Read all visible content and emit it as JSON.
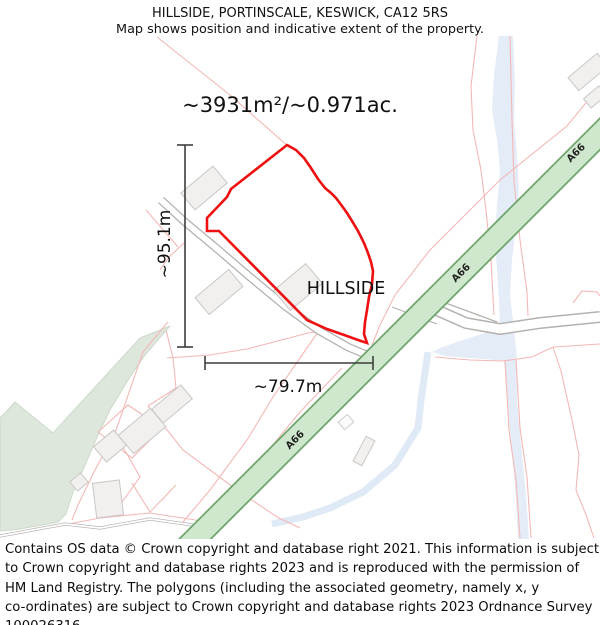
{
  "header": {
    "title": "HILLSIDE, PORTINSCALE, KESWICK, CA12 5RS",
    "subtitle": "Map shows position and indicative extent of the property."
  },
  "map": {
    "area_label": "~3931m²/~0.971ac.",
    "property_label": "HILLSIDE",
    "height_label": "~95.1m",
    "width_label": "~79.7m",
    "road_labels": [
      "A66",
      "A66",
      "A66"
    ],
    "colors": {
      "property_outline": "#ee1010",
      "parcel_line": "#f3b8b6",
      "road_fill": "#cfe8cd",
      "road_casing": "#6ea46e",
      "water": "#e4ecf7",
      "woodland": "#dde7db",
      "building_fill": "#f1f0ef",
      "building_stroke": "#c9c7c4",
      "dimension": "#3d3d3d"
    }
  },
  "footer": {
    "lines": [
      "Contains OS data © Crown copyright and database right 2021. This information is subject",
      "to Crown copyright and database rights 2023 and is reproduced with the permission of",
      "HM Land Registry. The polygons (including the associated geometry, namely x, y",
      "co-ordinates) are subject to Crown copyright and database rights 2023 Ordnance Survey",
      "100026316."
    ]
  }
}
